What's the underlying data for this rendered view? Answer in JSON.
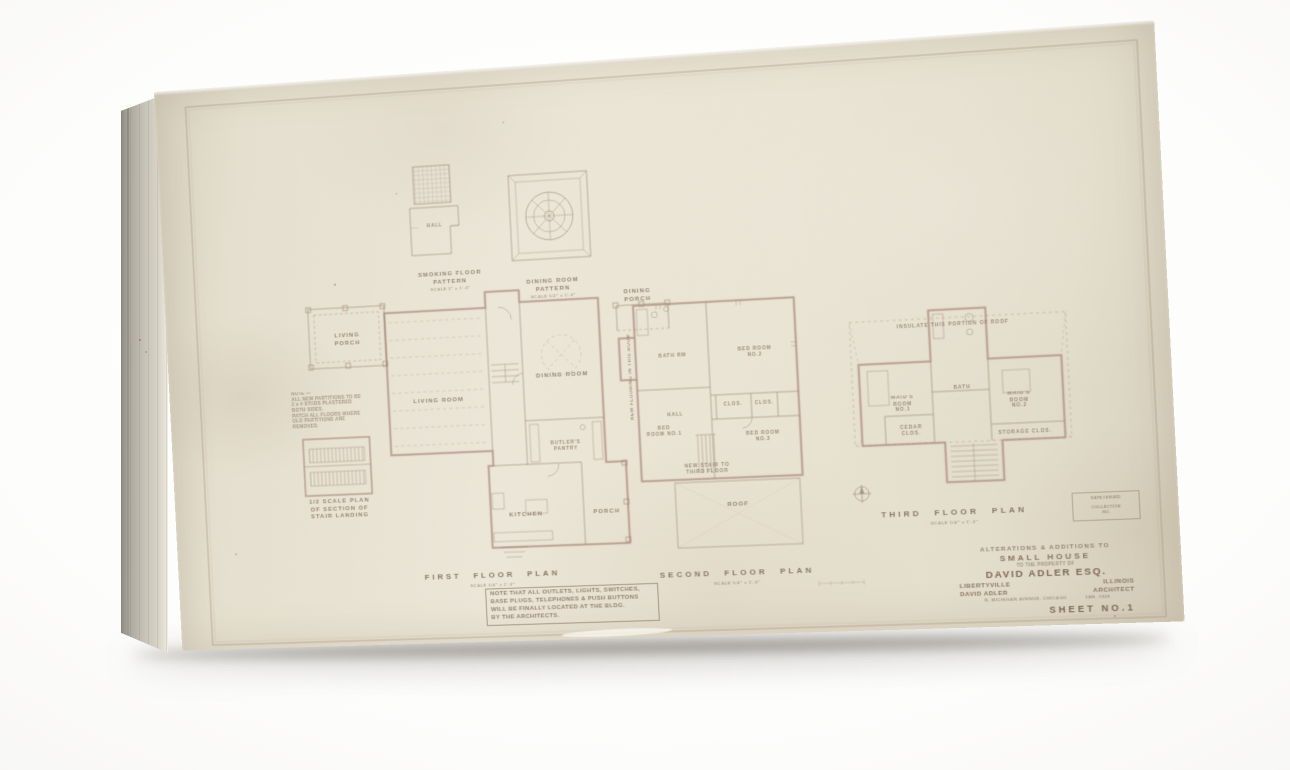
{
  "detail_plans": {
    "smoking": {
      "title": "SMOKING FLOOR\nPATTERN",
      "scale": "SCALE 3\" = 1'-0\"",
      "room_label": "HALL"
    },
    "dining_ceiling": {
      "title": "DINING ROOM\nPATTERN",
      "scale": "SCALE 1/2\" = 1'-0\""
    },
    "dining_porch": {
      "label": "DINING\nPORCH"
    },
    "stair_landing": {
      "title": "1/2 SCALE PLAN\nOF SECTION OF\nSTAIR LANDING"
    }
  },
  "first_floor": {
    "title": "FIRST FLOOR PLAN",
    "scale": "SCALE 1/4\" = 1'-0\"",
    "rooms": {
      "living_porch": "LIVING\nPORCH",
      "living_room": "LIVING ROOM",
      "dining_room": "DINING ROOM",
      "butlers_pantry": "BUTLER'S\nPANTRY",
      "kitchen": "KITCHEN",
      "porch": "PORCH"
    },
    "note_lines": [
      "NOTE THAT ALL OUTLETS, LIGHTS, SWITCHES,",
      "BASE PLUGS, TELEPHONES & PUSH BUTTONS",
      "WILL BE FINALLY LOCATED AT THE BLDG.",
      "BY THE ARCHITECTS."
    ]
  },
  "second_floor": {
    "title": "SECOND FLOOR PLAN",
    "scale": "SCALE 1/4\" = 1'-0\"",
    "rooms": {
      "bed1": "BED\nROOM NO.1",
      "bed2": "BED ROOM\nNO.2",
      "bed3": "BED ROOM\nNO.3",
      "bath": "BATH RM",
      "hall": "HALL",
      "clos1": "CLOS.",
      "clos2": "CLOS.",
      "roof": "ROOF"
    },
    "side_note": "NEW FLOORING IN THIS ROOM",
    "stair_note": "NEW STAIR TO\nTHIRD FLOOR"
  },
  "third_floor": {
    "title": "THIRD FLOOR PLAN",
    "scale": "SCALE 1/4\" = 1'-0\"",
    "rooms": {
      "maid1": "MAID'S\nROOM\nNO.1",
      "maid2": "MAID'S\nROOM\nNO.2",
      "bath": "BATH",
      "cedar": "CEDAR\nCLOS.",
      "storage": "STORAGE  CLOS."
    },
    "roof_note": "INSULATE THIS PORTION OF ROOF"
  },
  "general_note_lines": [
    "NOTE —",
    "ALL NEW PARTITIONS TO BE",
    "2 x 4 STUDS PLASTERED",
    "BOTH SIDES.",
    "PATCH ALL FLOORS WHERE",
    "OLD PARTITIONS ARE",
    "REMOVED."
  ],
  "stamp_lines": [
    "DATE ISSUED",
    "COLLECTION NO."
  ],
  "title_block": {
    "line1": "ALTERATIONS & ADDITIONS TO",
    "line2": "SMALL HOUSE",
    "line3": "TO THE PROPERTY OF",
    "owner": "DAVID ADLER ESQ.",
    "place_left": "LIBERTYVILLE",
    "place_right": "ILLINOIS",
    "architect_name": "DAVID ADLER",
    "architect_title": "ARCHITECT",
    "address": "N. MICHIGAN AVENUE, CHICAGO",
    "date": "JAN. 1926",
    "sheet_no": "SHEET NO.1"
  },
  "colors": {
    "ink": "#9a8673",
    "wall": "#c7a198",
    "lettering": "#8c7866",
    "paper": "#e9e3d3"
  }
}
